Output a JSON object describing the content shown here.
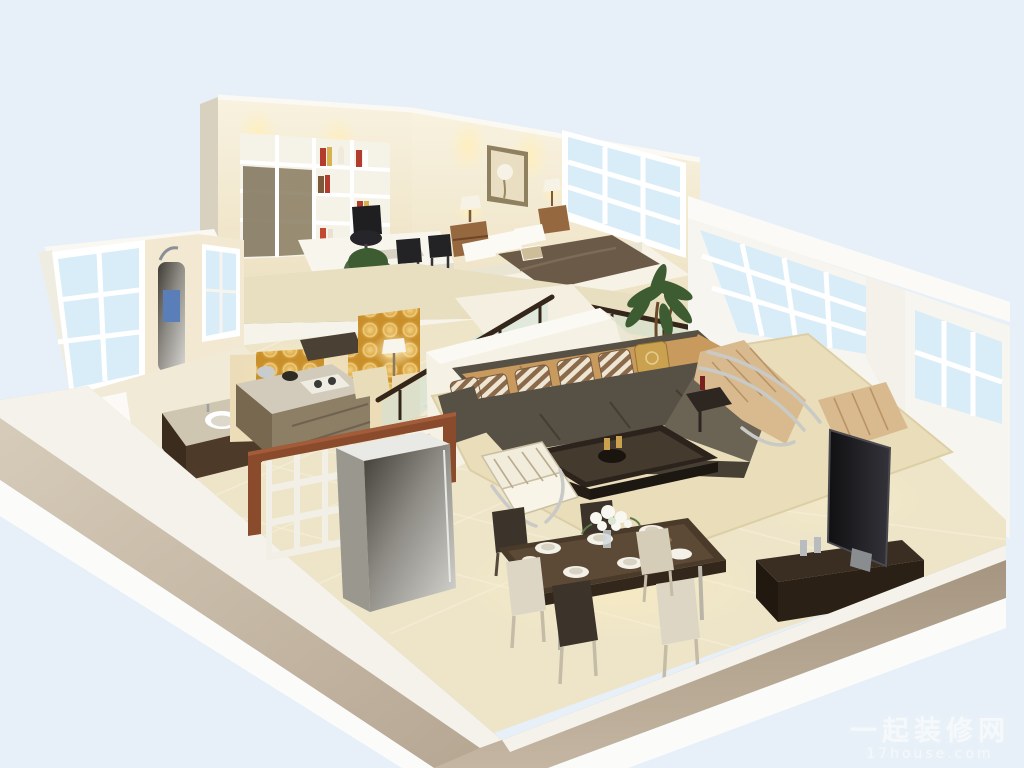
{
  "image": {
    "kind": "3d-interior-cutaway-render",
    "subject": "duplex loft apartment dollhouse view",
    "width_px": 1024,
    "height_px": 768
  },
  "watermark": {
    "site_name": "一起装修网",
    "site_url": "17house.com"
  },
  "scene": {
    "view": "elevated isometric cutaway, roof removed",
    "levels": [
      {
        "name": "mezzanine",
        "rooms": [
          {
            "name": "study",
            "furniture": [
              "bookshelf wall unit",
              "white desk",
              "black office chair",
              "two guest chairs",
              "potted plant",
              "file cabinets"
            ]
          },
          {
            "name": "bedroom",
            "furniture": [
              "platform bed with brown duvet",
              "white pillows",
              "two wood nightstands",
              "two table lamps",
              "framed picture",
              "gridded window"
            ]
          }
        ]
      },
      {
        "name": "ground-floor",
        "rooms": [
          {
            "name": "bathroom",
            "furniture": [
              "toilet",
              "dark wood sink vanity",
              "shower panel",
              "two windows"
            ]
          },
          {
            "name": "kitchen",
            "furniture": [
              "gold damask backsplash",
              "counters with drawers",
              "cooktop",
              "kettle",
              "refrigerator"
            ]
          },
          {
            "name": "living-room",
            "furniture": [
              "L-shaped dark sectional sofa",
              "tan back cushions",
              "striped throw pillows",
              "coffee table",
              "white slat accent chair",
              "tan chaise lounge",
              "ottoman",
              "flat-screen TV",
              "media bench",
              "area rug",
              "palm plant",
              "window wall"
            ]
          },
          {
            "name": "dining-area",
            "furniture": [
              "dark wood dining table",
              "six chairs",
              "place settings",
              "white flower centerpiece"
            ]
          }
        ]
      },
      {
        "name": "circulation",
        "rooms": [
          {
            "name": "staircase",
            "furniture": [
              "white steps",
              "glass balustrade",
              "dark handrail",
              "gold accent wall",
              "floor lamp",
              "cube shelf room divider"
            ]
          }
        ]
      }
    ]
  },
  "palette": {
    "sky": "#e7f0f8",
    "wall_white": "#f7f5ef",
    "wall_cream": "#f3e9d2",
    "wall_warm": "#ecdcb8",
    "cut_band": "#b9a археолог",
    "floor": "#eee5c9",
    "carpet": "#e8dfc0",
    "rug": "#e9ddba",
    "gold_accent": "#d9a435",
    "sofa_dark": "#575044",
    "sofa_light": "#6b6353",
    "cushion_tan": "#c89a5e",
    "cushion_tan_light": "#d9ba8e",
    "wood": "#96683f",
    "wood_red": "#8a4a2c",
    "table_dark": "#3e3227",
    "glass_window": "#d9edf8",
    "glass_stair": "#cfe4d8",
    "handrail": "#34261a",
    "steel": "#b7bcc0",
    "tv_black": "#17171a",
    "plant_green": "#3d5c32",
    "lamp_glow": "#ffe9ad",
    "watermark": "#ffffff"
  }
}
